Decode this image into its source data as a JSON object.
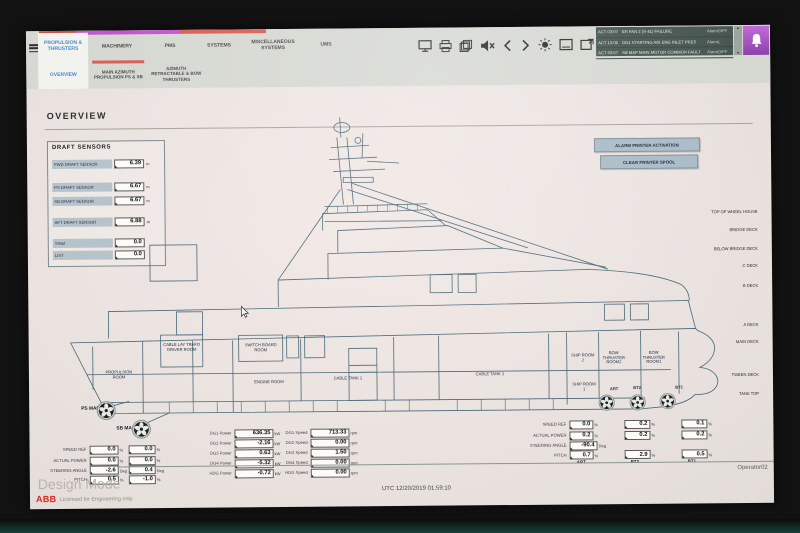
{
  "menu": {
    "tabs": [
      {
        "label": "PROPULSION & THRUSTERS"
      },
      {
        "label": "MACHINERY"
      },
      {
        "label": "PMS"
      },
      {
        "label": "SYSTEMS"
      },
      {
        "label": "MISCELLANEOUS SYSTEMS"
      },
      {
        "label": "UMS"
      }
    ],
    "subtabs": [
      {
        "label": "OVERVIEW"
      },
      {
        "label": "MAIN AZIMUTH PROPULSION PS & SB"
      },
      {
        "label": "AZIMUTH RETRACTABLE & BOW THRUSTERS"
      }
    ],
    "icons": [
      "monitor-icon",
      "printer-icon",
      "pages-icon",
      "speaker-mute-icon",
      "prev-arrow-icon",
      "next-arrow-icon",
      "brightness-icon",
      "screen-icon",
      "screen-switch-icon",
      "alarm-bell-icon"
    ],
    "indicator_colors": {
      "red": "#d95f55",
      "magenta": "#c455d0"
    }
  },
  "alarm_bar": {
    "rows": [
      {
        "time": "ACT 03:07",
        "text": "ER FAN 2 (S-41) FAILURE",
        "status": "AlarmDIFF"
      },
      {
        "time": "ACT 13:05",
        "text": "DG1 STARTING AIR ENG INLET PRES",
        "status": "AlarmL"
      },
      {
        "time": "ACT 03:57",
        "text": "SB MAP MAIN MOTOR COMMON FAULT",
        "status": "AlarmDIFF"
      }
    ]
  },
  "page": {
    "title": "OVERVIEW"
  },
  "draft_sensors": {
    "title": "DRAFT SENSORS",
    "rows": [
      {
        "label": "FWD DRAFT SENSOR",
        "value": "6.39",
        "unit": "m"
      },
      {
        "label": "PS DRAFT SENSOR",
        "value": "6.67",
        "unit": "m"
      },
      {
        "label": "SB DRAFT SENSOR",
        "value": "6.67",
        "unit": "m"
      },
      {
        "label": "AFT DRAFT SENSOR",
        "value": "6.88",
        "unit": "m"
      },
      {
        "label": "TRIM",
        "value": "0.0",
        "unit": ""
      },
      {
        "label": "LIST",
        "value": "0.0",
        "unit": ""
      }
    ]
  },
  "printer_buttons": {
    "alarm": "ALARM PRINTER ACTIVATION",
    "clear": "CLEAR PRINTER SPOOL"
  },
  "decks": [
    "TOP OF WHEEL HOUSE",
    "BRIDGE DECK",
    "BELOW BRIDGE DECK",
    "C DECK",
    "B DECK",
    "A DECK",
    "MAIN DECK",
    "TWEEN DECK",
    "TANK TOP"
  ],
  "rooms": {
    "propulsion": "PROPULSION ROOM",
    "cable_lay": "CABLE LAY TRAFO DRIVER ROOM",
    "switchboard": "SWITCH BOARD ROOM",
    "engine": "ENGINE ROOM",
    "cable_tank2": "CABLE TANK 2",
    "cable_tank1": "CABLE TANK 1",
    "ship_room2": "SHIP ROOM 2",
    "bow_thruster_room2": "BOW THRUSTER ROOM2",
    "bow_thruster_room1": "BOW THRUSTER ROOM1",
    "ship_room1": "SHIP ROOM 1"
  },
  "thrusters": {
    "ps": "PS MAP",
    "sb": "SB MAP",
    "art": "ART",
    "bt2": "BT2",
    "bt1": "BT1"
  },
  "map_stats": {
    "rows": [
      {
        "label": "SPEED REF",
        "ps": "0.0",
        "sb": "0.0",
        "unit": "%"
      },
      {
        "label": "ACTUAL POWER",
        "ps": "0.0",
        "sb": "0.0",
        "unit": "%"
      },
      {
        "label": "STEERING ANGLE",
        "ps": "-2.6",
        "sb": "0.4",
        "unit": "Deg"
      },
      {
        "label": "PITCH",
        "ps": "0.5",
        "sb": "-1.0",
        "unit": "%"
      }
    ]
  },
  "dg_stats": {
    "rows": [
      {
        "p_label": "DG1 Power",
        "p_value": "636.35",
        "p_unit": "kW",
        "s_label": "DG1 Speed",
        "s_value": "713.33",
        "s_unit": "rpm"
      },
      {
        "p_label": "DG2 Power",
        "p_value": "-2.16",
        "p_unit": "kW",
        "s_label": "DG2 Speed",
        "s_value": "0.00",
        "s_unit": "rpm"
      },
      {
        "p_label": "DG3 Power",
        "p_value": "0.63",
        "p_unit": "kW",
        "s_label": "DG3 Speed",
        "s_value": "1.50",
        "s_unit": "rpm"
      },
      {
        "p_label": "DG4 Power",
        "p_value": "-5.32",
        "p_unit": "kW",
        "s_label": "DG4 Speed",
        "s_value": "0.00",
        "s_unit": "rpm"
      },
      {
        "p_label": "HDG Power",
        "p_value": "-0.72",
        "p_unit": "kW",
        "s_label": "HDG Speed",
        "s_value": "0.00",
        "s_unit": "rpm"
      }
    ]
  },
  "bow_stats": {
    "rows": [
      {
        "label": "SPEED REF",
        "art": "0.0",
        "bt2": "0.2",
        "bt1": "0.1",
        "unit": "%"
      },
      {
        "label": "ACTUAL POWER",
        "art": "0.2",
        "bt2": "0.2",
        "bt1": "0.2",
        "unit": "%"
      },
      {
        "label": "STEERING ANGLE",
        "art": "-90.4",
        "bt2": "",
        "bt1": "",
        "unit": "Deg"
      },
      {
        "label": "PITCH",
        "art": "0.7",
        "bt2": "2.9",
        "bt1": "0.5",
        "unit": "%"
      }
    ],
    "footers": [
      "ART",
      "BT2",
      "BT1"
    ]
  },
  "footer": {
    "mode": "Design Mode",
    "utc": "UTC  12/20/2019 01:59:10",
    "operator": "Operator02",
    "brand": "ABB",
    "license": "Licensed for Engineering only"
  }
}
